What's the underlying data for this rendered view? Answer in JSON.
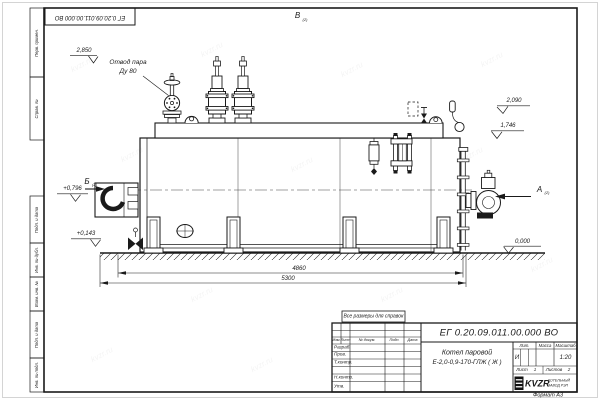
{
  "watermark": "kvzr.ru",
  "doc_number_top": "ЕГ 0.20.09.011.00.000  ВО",
  "margin": {
    "boxes": [
      "Перв. примен.",
      "Справ. №",
      "Подп. и дата",
      "Инв. № дубл.",
      "Взам. инв. №",
      "Подп. и дата",
      "Инв. № подл."
    ]
  },
  "views": {
    "top_label": "В",
    "front_label": "Б",
    "side_label": "А",
    "sheet_ref": "(2)"
  },
  "callout": {
    "line1": "Отвод пара",
    "line2": "Ду 80"
  },
  "levels": {
    "valve_top": "2,850",
    "drum_top": "2,090",
    "shell_top": "1,746",
    "burner_axis": "+0,796",
    "manhole_axis": "+0,143",
    "ground": "0,000"
  },
  "dims": {
    "support_span": "4860",
    "overall_length": "5300"
  },
  "note": "Все размеры для справок",
  "title_block": {
    "designation": "ЕГ 0.20.09.011.00.000  ВО",
    "product_line1": "Котел паровой",
    "product_line2": "Е-2,0-0,9-170-ГЛЖ ( Ж )",
    "rev_headers": {
      "izm": "Изм.",
      "list": "Лист",
      "doc": "№ докум.",
      "podp": "Подп.",
      "data": "Дата"
    },
    "signature_rows": [
      "Разраб.",
      "Пров.",
      "Т.контр.",
      "Н.контр.",
      "Утв."
    ],
    "lit_header": "Лит.",
    "mass_header": "Масса",
    "scale_header": "Масштаб",
    "lit_value": "И",
    "scale_value": "1:20",
    "sheet_label": "Лист",
    "sheet_value": "1",
    "sheets_label": "Листов",
    "sheets_value": "2",
    "company": {
      "logo": "KVZR",
      "sub1": "КОТЕЛЬНЫЙ",
      "sub2": "ЗАВОД РЭП"
    },
    "format_note": "Формат А3"
  }
}
